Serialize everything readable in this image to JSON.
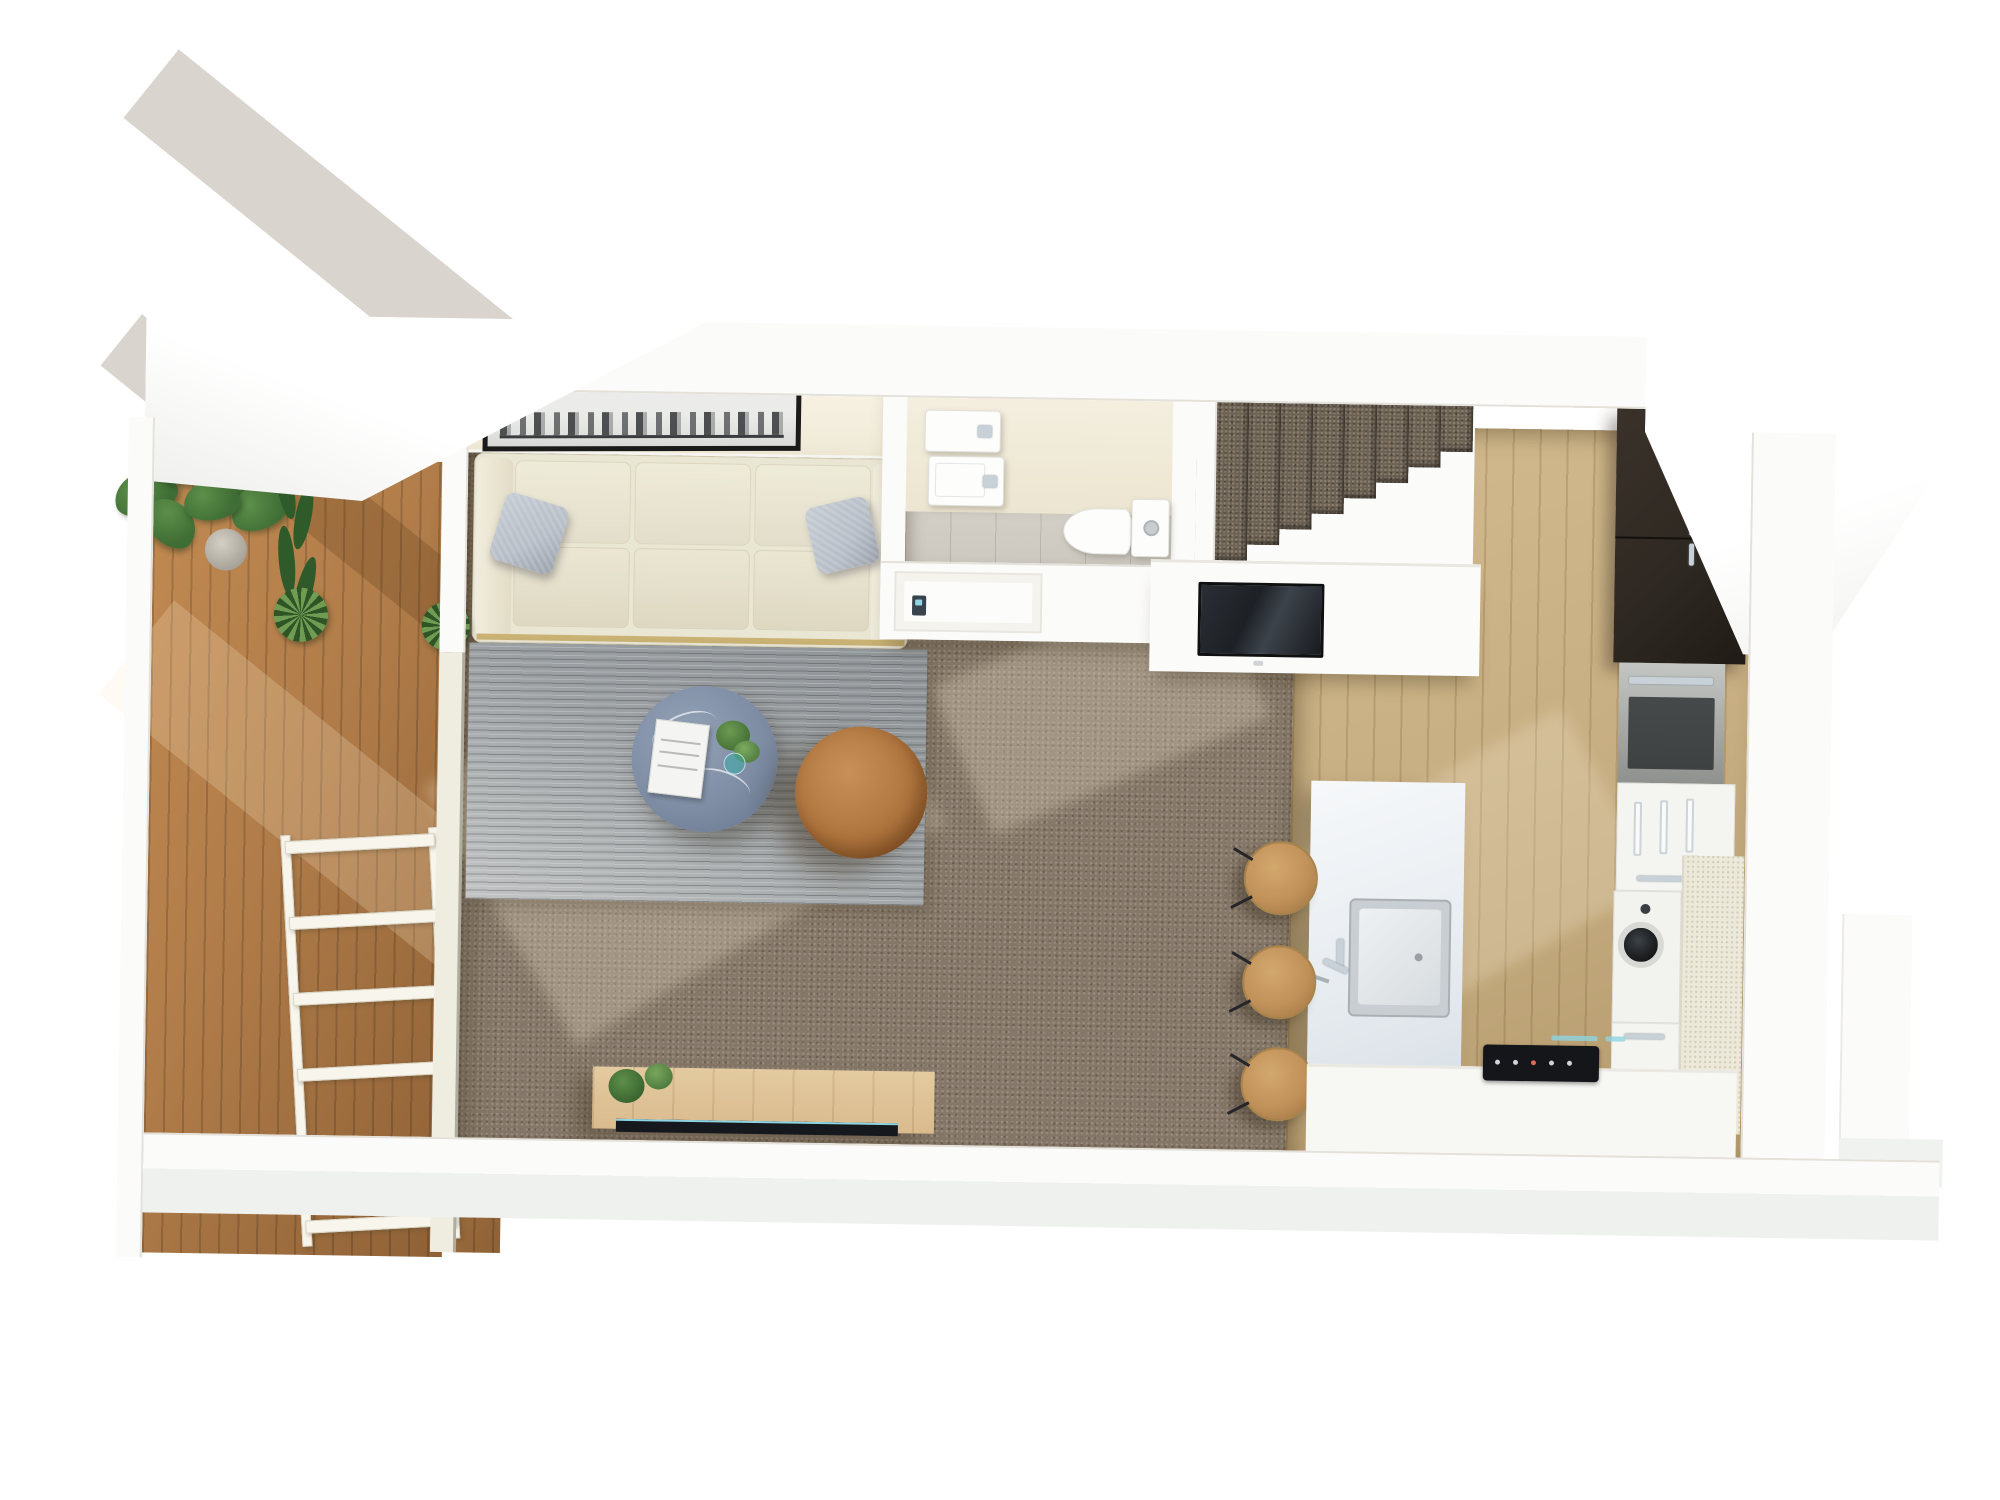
{
  "scene": {
    "title": "3D floor plan render — studio apartment with balcony",
    "background": "#ffffff"
  },
  "colors": {
    "bg": "#ffffff",
    "wall": "#fbfbf9",
    "wall-edge": "#e3e1da",
    "cream": "#efe9d6",
    "carpet": "#867868",
    "rug": "#9ba0a3",
    "deck": "#b07c49",
    "deck-dark": "#8e6136",
    "oak": "#c7ae82",
    "oak-dark": "#b49a6d",
    "sofa": "#eae6d4",
    "pillow": "#b7bdc6",
    "table": "#7e8da4",
    "pouf": "#b0763f",
    "pouf-dark": "#8a562a",
    "stairs": "#6d6152",
    "tile": "#cdc9c1",
    "dark-cab": "#2e2822",
    "tv": "#15181c",
    "console": "#d9bb8e",
    "plant": "#3f6d35",
    "plant-light": "#5d8f4a",
    "chrome": "#c8d1d8",
    "glint": "#8fd4e2",
    "gold": "#c9b274",
    "stool": "#c1915a",
    "bench": "#ece9da"
  },
  "rooms": {
    "balcony": "Balcony timber deck",
    "living": "Living room",
    "bathroom": "Bathroom",
    "stairs": "Carpeted staircase",
    "kitchen": "Kitchen",
    "hallway": "Hallway"
  },
  "labels": {
    "deck": "timber decking boards",
    "railing": "white balcony railing",
    "monstera": "potted monstera plant",
    "fern": "fern plant",
    "rosette1": "round leafy plant",
    "rosette2": "round leafy plant",
    "artwork": "framed black and white city skyline print",
    "sofa": "cream three-seat sofa",
    "pillow_left": "grey throw pillow",
    "pillow_right": "grey throw pillow",
    "rug": "grey woven area rug",
    "coffee_table": "round blue-grey stone coffee table",
    "book": "coffee table book",
    "table_plant": "greenery in glass vase",
    "pouf": "round tan leather ottoman",
    "console": "oak media console",
    "console_plants": "potted plants on console",
    "console_tv": "flat TV panel on wall",
    "basin_upper": "wall basin with mirror cabinet",
    "basin_lower": "wall basin",
    "toilet": "toilet with cistern",
    "bath_door": "bathroom door",
    "keypad": "door keypad",
    "stair_steps": "carpeted steps descending to entry",
    "bulkhead_tv": "wall-mounted TV facing living area",
    "dark_cabinets": "charcoal full-height cabinets",
    "wall_oven": "stainless steel wall oven",
    "white_cabinet": "white cabinet with pull handles",
    "washing_machine": "front-load washing machine",
    "benchtop": "stone benchtop return",
    "island": "white kitchen island",
    "island_sink": "stainless island sink",
    "faucet": "chrome mixer tap",
    "stool1": "timber bar stool",
    "stool2": "timber bar stool",
    "stool3": "timber bar stool",
    "cooktop": "black induction cooktop",
    "oak_floor": "oak kitchen flooring",
    "carpet_floor": "brown carpet flooring",
    "tile_floor": "grey tiled bathroom floor"
  }
}
